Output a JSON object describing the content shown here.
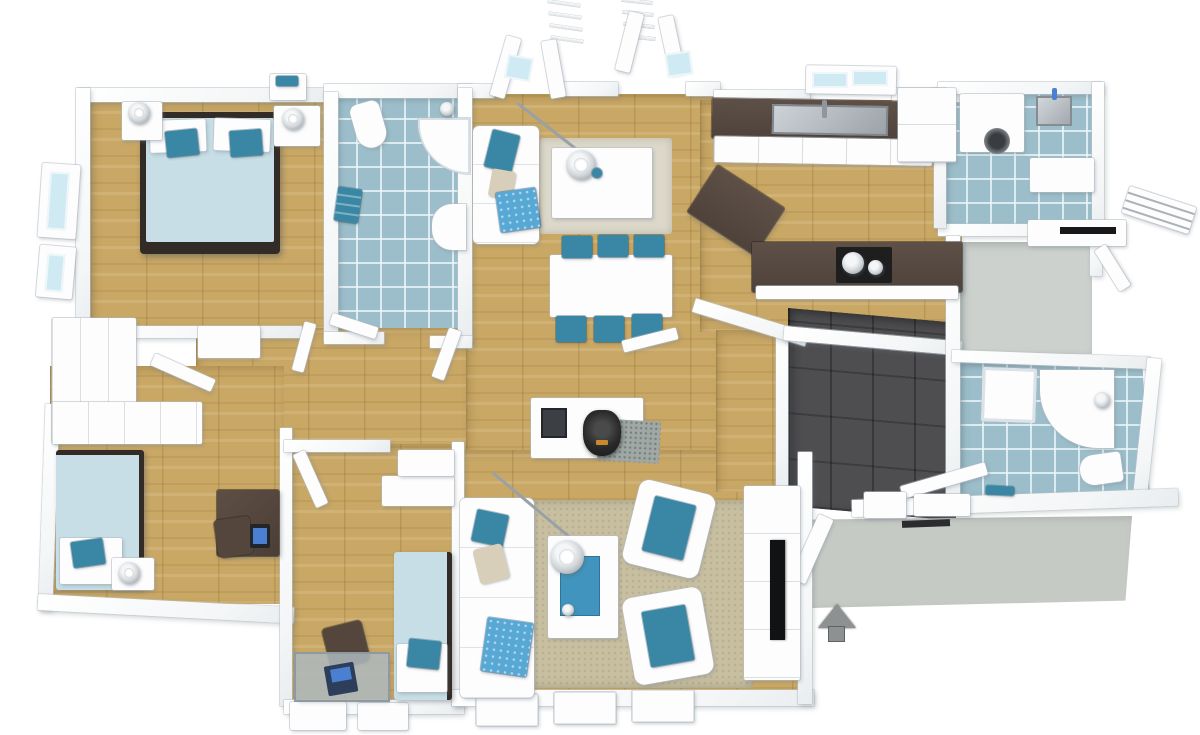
{
  "scene": {
    "type": "3d-floor-plan-render",
    "view": "top-down aerial 3D render of a single-story house, no text labels",
    "style": "white walls, light oak floors, blue-tiled wet rooms, teal accent furniture",
    "entrance_indicator": "grey arrow pointing up at the driveway edge"
  },
  "colors": {
    "wall": "#fdfdfe",
    "wood": "#c9a765",
    "tile": "#9cbeca",
    "grout": "#ecf6f9",
    "garage": "#4e4e50",
    "porch": "#c6cac5",
    "entry": "#ccd1cd",
    "accent": "#3a86a5",
    "bedding": "#c7dee6",
    "pattern": "#58a8d6",
    "frame": "#332c26",
    "counter": "#5e5047",
    "rug": "#c8bfa1",
    "ruglight": "#dcd8ca",
    "stone": "#9fa8a4",
    "stove": "#2a2a2a",
    "metal": "#b9bec2",
    "screen": "#4a7fd1",
    "deskwood": "#55463d",
    "glass": "#cfeaf3",
    "arrow": "#8e9192"
  },
  "rooms": [
    {
      "name": "Master Bedroom",
      "floor": "light oak plank",
      "furniture": [
        "double bed with dark frame and light-blue duvet",
        "2 white pillows",
        "2 teal accent pillows",
        "left nightstand with dome lamp",
        "right nightstand with dome lamp",
        "corner wardrobe",
        "2 bay windows on left wall",
        "shelf with teal towels"
      ]
    },
    {
      "name": "Master Bathroom",
      "floor": "blue ceramic tile",
      "furniture": [
        "wall-hung toilet",
        "corner shower with curved glass",
        "washbasin vanity",
        "towel rail with teal towels"
      ]
    },
    {
      "name": "Living / Dining Room",
      "floor": "light oak plank",
      "furniture": [
        "white lounge sofa with teal, beige and dotted-blue cushions",
        "arc floor lamp over side table",
        "white side table with dome lamp and teal cup",
        "light beige rug",
        "white dining table",
        "6 teal dining chairs",
        "media bench with inset firebox",
        "black wood stove on granite pad",
        "white 3-seat sofa",
        "2 white armchairs with teal cushions",
        "white coffee table with blue runner and dome lamp",
        "large beige area rug",
        "TV sideboard with flat-screen TV",
        "2 sets of open french doors with juliet railings",
        "3 windows on bottom wall"
      ]
    },
    {
      "name": "Kitchen",
      "floor": "light oak plank",
      "furniture": [
        "wall counter with dark worktop",
        "double stainless sink with faucet",
        "tall fridge cabinet",
        "angled island with dark worktop",
        "black cooktop with 2 metal pots"
      ]
    },
    {
      "name": "Utility Room",
      "floor": "blue ceramic tile",
      "furniture": [
        "washing machine with round door",
        "stainless utility sink",
        "white storage cabinet"
      ]
    },
    {
      "name": "Entry Hall",
      "floor": "grey stone",
      "furniture": [
        "entrance door ajar",
        "white entrance canopy",
        "dark doormat slot"
      ]
    },
    {
      "name": "Bathroom 2",
      "floor": "blue ceramic tile",
      "furniture": [
        "glass shower cabin",
        "curved vanity with washbasin and faucet",
        "toilet",
        "teal bath mat"
      ]
    },
    {
      "name": "Garage",
      "floor": "anthracite tile",
      "furniture": [
        "white storage boxes at entry step"
      ]
    },
    {
      "name": "Bedroom 2",
      "floor": "light oak plank",
      "furniture": [
        "single bed with light-blue duvet",
        "white pillow with teal cushion",
        "nightstand with dome lamp",
        "dark wood desk with monitor",
        "desk chair",
        "white wardrobe block"
      ]
    },
    {
      "name": "Bedroom 3",
      "floor": "light oak plank",
      "furniture": [
        "single bed with light-blue duvet",
        "white pillow with teal cushion",
        "glass desk with open laptop",
        "desk chair",
        "wardrobe cabinet",
        "2 windows on bottom wall"
      ]
    },
    {
      "name": "Hallway",
      "floor": "light oak plank",
      "furniture": [
        "white sideboard",
        "interior doors ajar at bedroom, bathroom, living and garage openings"
      ]
    },
    {
      "name": "Porch / Driveway",
      "floor": "light grey concrete",
      "furniture": [
        "long white entrance step",
        "open porch door",
        "wall-mounted drying rack",
        "grey entrance arrow pointing up"
      ]
    }
  ]
}
